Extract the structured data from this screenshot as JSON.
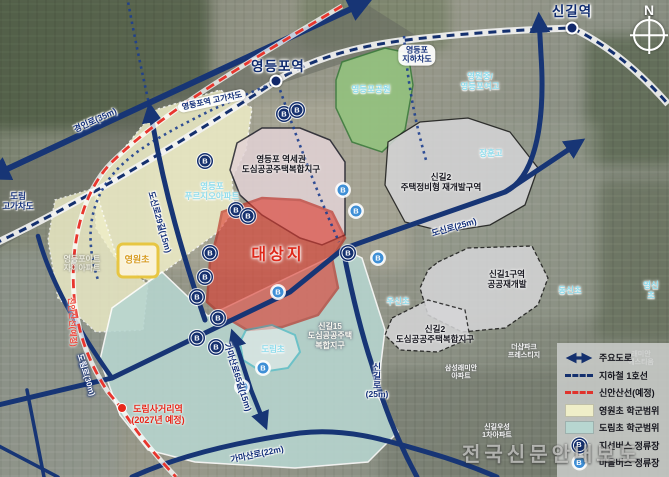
{
  "compass": {
    "label": "N"
  },
  "watermark": {
    "text": "전국신문안내보도"
  },
  "colors": {
    "road_navy": "#173575",
    "line1_navy": "#14306e",
    "sinansan_red": "#e8362e",
    "site_red": "#df281a",
    "cream_zone": "#efeec8",
    "teal_zone": "#b7d6d0",
    "park_green": "#93c27e",
    "jisun_bus": "#15306e",
    "maeul_bus": "#3f8fd6"
  },
  "stations": [
    {
      "name": "영등포역",
      "x": 278,
      "y": 67,
      "dot_x": 276,
      "dot_y": 81
    },
    {
      "name": "신길역",
      "x": 572,
      "y": 12,
      "dot_x": 572,
      "dot_y": 28
    }
  ],
  "planned_station": {
    "name": "도림사거리역",
    "note": "(2027년 예정)",
    "x": 158,
    "y": 415,
    "dot_x": 122,
    "dot_y": 408
  },
  "map_labels": [
    {
      "name": "road-label-gyeongin",
      "text": "경인로(35m)",
      "x": 95,
      "y": 120,
      "cls": "road",
      "rot": -25
    },
    {
      "name": "label-ydp-overpass",
      "text": "영등포역 고가차도",
      "x": 212,
      "y": 101,
      "cls": "pill",
      "rot": -12
    },
    {
      "name": "label-ydp-underpass",
      "text": "영등포\n지하차도",
      "x": 417,
      "y": 55,
      "cls": "pill",
      "rot": 0
    },
    {
      "name": "label-dorim-overpass",
      "text": "도림\n고가차도",
      "x": 18,
      "y": 201,
      "cls": "road",
      "rot": 0
    },
    {
      "name": "road-label-dosin29",
      "text": "도신로29길(15m)",
      "x": 160,
      "y": 222,
      "cls": "road",
      "rot": 74
    },
    {
      "name": "road-label-dosin25",
      "text": "도신로(25m)",
      "x": 454,
      "y": 227,
      "cls": "road",
      "rot": -16
    },
    {
      "name": "road-label-singil",
      "text": "신\n길\n로\n(25m)",
      "x": 377,
      "y": 381,
      "cls": "road-v",
      "rot": 0
    },
    {
      "name": "road-label-gamasan65",
      "text": "가마산로65길(15m)",
      "x": 238,
      "y": 377,
      "cls": "road",
      "rot": 72
    },
    {
      "name": "road-label-gamasan",
      "text": "가마산로(22m)",
      "x": 257,
      "y": 454,
      "cls": "road",
      "rot": -12
    },
    {
      "name": "road-label-dorim",
      "text": "도림로(30m)",
      "x": 86,
      "y": 375,
      "cls": "road-w",
      "rot": 73
    },
    {
      "name": "line-label-sinansan",
      "text": "신안산선(예정)",
      "x": 72,
      "y": 322,
      "cls": "redline",
      "rot": 87
    },
    {
      "name": "area-label-yeokse",
      "text": "영등포 역세권\n도심공공주택복합지구",
      "x": 281,
      "y": 164,
      "cls": "dark",
      "rot": 0
    },
    {
      "name": "area-label-singil2-redev",
      "text": "신길2\n주택정비형 재개발구역",
      "x": 441,
      "y": 182,
      "cls": "dark",
      "rot": 0
    },
    {
      "name": "area-label-singil1",
      "text": "신길1구역\n공공재개발",
      "x": 507,
      "y": 279,
      "cls": "dark",
      "rot": 0
    },
    {
      "name": "area-label-singil2-public",
      "text": "신길2\n도심공공주택복합지구",
      "x": 435,
      "y": 334,
      "cls": "dark",
      "rot": 0
    },
    {
      "name": "area-label-singil15",
      "text": "신길15\n도심공공주택\n복합지구",
      "x": 330,
      "y": 336,
      "cls": "white-lbl",
      "rot": 0
    },
    {
      "name": "area-label-site",
      "text": "대상지",
      "x": 278,
      "y": 256,
      "cls": "site",
      "rot": 0
    },
    {
      "name": "area-label-park",
      "text": "영등포공원",
      "x": 371,
      "y": 89,
      "cls": "cyan",
      "rot": 0
    },
    {
      "name": "label-prugio-apt",
      "text": "영등포\n푸르지오아파트",
      "x": 212,
      "y": 191,
      "cls": "cyan",
      "rot": 0
    },
    {
      "name": "label-yeongwon-mid",
      "text": "영원중/\n영등포여고",
      "x": 480,
      "y": 81,
      "cls": "cyan",
      "rot": 0
    },
    {
      "name": "label-janghoon-high",
      "text": "장훈고",
      "x": 491,
      "y": 153,
      "cls": "cyan",
      "rot": 0
    },
    {
      "name": "label-woosin-elem",
      "text": "우신초",
      "x": 398,
      "y": 301,
      "cls": "cyan",
      "rot": 0
    },
    {
      "name": "label-dongsin-elem",
      "text": "동신초",
      "x": 570,
      "y": 290,
      "cls": "cyan",
      "rot": 0
    },
    {
      "name": "label-yeongsin-elem",
      "text": "영신초",
      "x": 651,
      "y": 290,
      "cls": "cyan",
      "rot": 0
    },
    {
      "name": "label-dorim-elem",
      "text": "도림초",
      "x": 273,
      "y": 349,
      "cls": "cyan",
      "rot": 0
    },
    {
      "name": "label-yeongwon-elem",
      "text": "영원초",
      "x": 137,
      "y": 260,
      "cls": "yellow-lbl",
      "rot": 0
    },
    {
      "name": "label-art-xi-apt",
      "text": "영등포아트\n자이아파트",
      "x": 82,
      "y": 264,
      "cls": "gray-lbl",
      "rot": 0
    },
    {
      "name": "label-samsung-apt",
      "text": "삼성래미안\n아파트",
      "x": 461,
      "y": 373,
      "cls": "faint",
      "rot": 0
    },
    {
      "name": "label-woosung-apt",
      "text": "신길우성\n1차아파트",
      "x": 497,
      "y": 432,
      "cls": "faint",
      "rot": 0
    },
    {
      "name": "label-thesharp-apt",
      "text": "더샵파크\n프레스티지",
      "x": 524,
      "y": 352,
      "cls": "faint",
      "rot": 0
    },
    {
      "name": "label-raemian-apt",
      "text": "래미안\n에스티움",
      "x": 641,
      "y": 359,
      "cls": "faint",
      "rot": 0
    }
  ],
  "bus_stops": {
    "jisun": [
      [
        284,
        114
      ],
      [
        297,
        110
      ],
      [
        205,
        161
      ],
      [
        236,
        210
      ],
      [
        248,
        216
      ],
      [
        210,
        253
      ],
      [
        205,
        277
      ],
      [
        197,
        297
      ],
      [
        197,
        338
      ],
      [
        216,
        347
      ],
      [
        348,
        253
      ],
      [
        218,
        318
      ]
    ],
    "maeul": [
      [
        343,
        190
      ],
      [
        356,
        211
      ],
      [
        278,
        292
      ],
      [
        263,
        368
      ],
      [
        242,
        387
      ],
      [
        378,
        258
      ]
    ]
  },
  "legend": {
    "items": [
      {
        "label": "주요도로",
        "swatch": "road-arrow"
      },
      {
        "label": "지하철 1호선",
        "swatch": "navy-dash"
      },
      {
        "label": "신안산선(예정)",
        "swatch": "red-dash"
      },
      {
        "label": "영원초 학군범위",
        "swatch": "cream"
      },
      {
        "label": "도림초 학군범위",
        "swatch": "teal"
      },
      {
        "label": "지선버스 정류장",
        "swatch": "jisun"
      },
      {
        "label": "마을버스 정류장",
        "swatch": "maeul"
      }
    ]
  }
}
